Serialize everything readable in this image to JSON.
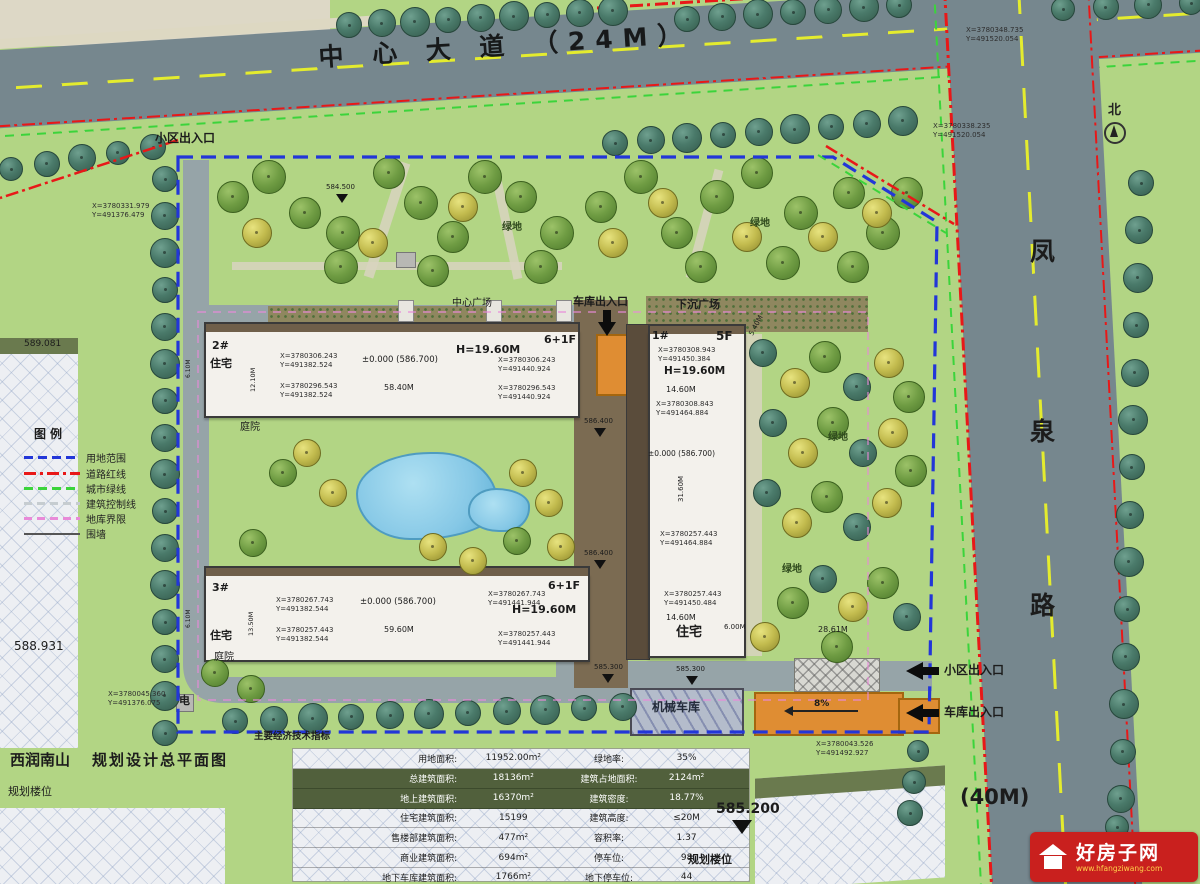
{
  "roads": {
    "main": "中 心 大 道 （24M）",
    "side_chars": [
      "凤",
      "泉",
      "路"
    ],
    "side_width": "(40M)",
    "north": "北"
  },
  "title": {
    "project": "西润南山",
    "drawing": "规划设计总平面图",
    "planned1": "规划楼位",
    "planned2": "规划楼位"
  },
  "legend": {
    "title": "图例",
    "items": [
      {
        "label": "用地范围",
        "color": "#2236d8",
        "style": "dashed"
      },
      {
        "label": "道路红线",
        "color": "#e81818",
        "style": "dash-dot"
      },
      {
        "label": "城市绿线",
        "color": "#3bd43b",
        "style": "dashed"
      },
      {
        "label": "建筑控制线",
        "color": "#c6ccd0",
        "style": "dashed"
      },
      {
        "label": "地库界限",
        "color": "#e88ad8",
        "style": "dashed"
      },
      {
        "label": "围墙",
        "color": "#555555",
        "style": "solid"
      }
    ]
  },
  "labels": {
    "entrance_top": "小区出入口",
    "garage_entrance_top": "车库出入口",
    "plaza_left": "中心广场",
    "plaza_right": "下沉广场",
    "entrance_side": "小区出入口",
    "garage_side": "车库出入口",
    "mech_garage": "机械车库",
    "electric": "电",
    "courtyard1": "庭院",
    "courtyard2": "庭院",
    "green1": "绿地",
    "green2": "绿地",
    "green3": "绿地",
    "green4": "绿地",
    "slope": "8%",
    "dim_2861": "28.61M",
    "dim_600": "6.00M"
  },
  "elevations": {
    "e1": "589.081",
    "e2": "588.931",
    "e3": "585.200",
    "e4": "585.300",
    "e5": "585.300",
    "e6": "584.500",
    "e7": "586.400",
    "e8": "586.400"
  },
  "site_coords": {
    "top_right_outer": [
      "X=3780348.735",
      "Y=491520.054"
    ],
    "top_right_inner": [
      "X=3780338.235",
      "Y=491520.054"
    ],
    "west": [
      "X=3780331.979",
      "Y=491376.479"
    ],
    "south_west": [
      "X=3780045.360",
      "Y=491376.075"
    ],
    "south_east": [
      "X=3780043.526",
      "Y=491492.927"
    ]
  },
  "buildings": {
    "b2": {
      "id": "2#",
      "type": "住宅",
      "floors": "6+1F",
      "height": "H=19.60M",
      "level": "±0.000 (586.700)",
      "length": "58.40M",
      "depth": "12.10M",
      "side": "6.10M",
      "nw": [
        "X=3780306.243",
        "Y=491382.524"
      ],
      "sw": [
        "X=3780296.543",
        "Y=491382.524"
      ],
      "ne": [
        "X=3780306.243",
        "Y=491440.924"
      ],
      "se": [
        "X=3780296.543",
        "Y=491440.924"
      ]
    },
    "b3": {
      "id": "3#",
      "type": "住宅",
      "floors": "6+1F",
      "height": "H=19.60M",
      "level": "±0.000 (586.700)",
      "length": "59.60M",
      "depth": "13.50M",
      "side": "6.10M",
      "nw": [
        "X=3780267.743",
        "Y=491382.544"
      ],
      "sw": [
        "X=3780257.443",
        "Y=491382.544"
      ],
      "ne": [
        "X=3780267.743",
        "Y=491441.944"
      ],
      "se": [
        "X=3780257.443",
        "Y=491441.944"
      ]
    },
    "b1": {
      "id": "1#",
      "type": "住宅",
      "floors": "5F",
      "height": "H=19.60M",
      "level": "±0.000 (586.700)",
      "width_top": "14.60M",
      "width_bottom": "14.60M",
      "depth": "31.60M",
      "gap": "5.40M",
      "c1": [
        "X=3780308.943",
        "Y=491450.384"
      ],
      "c2": [
        "X=3780308.843",
        "Y=491464.884"
      ],
      "c3": [
        "X=3780257.443",
        "Y=491464.884"
      ],
      "c4": [
        "X=3780257.443",
        "Y=491450.484"
      ]
    }
  },
  "table": {
    "header": "主要经济技术指标",
    "rows": [
      {
        "l1": "用地面积:",
        "v1": "11952.00m²",
        "l2": "绿地率:",
        "v2": "35%"
      },
      {
        "l1": "总建筑面积:",
        "v1": "18136m²",
        "l2": "建筑占地面积:",
        "v2": "2124m²"
      },
      {
        "l1": "地上建筑面积:",
        "v1": "16370m²",
        "l2": "建筑密度:",
        "v2": "18.77%"
      },
      {
        "l1": "住宅建筑面积:",
        "v1": "15199",
        "l2": "建筑高度:",
        "v2": "≤20M"
      },
      {
        "l1": "售楼部建筑面积:",
        "v1": "477m²",
        "l2": "容积率:",
        "v2": "1.37"
      },
      {
        "l1": "商业建筑面积:",
        "v1": "694m²",
        "l2": "停车位:",
        "v2": "98"
      },
      {
        "l1": "地下车库建筑面积:",
        "v1": "1766m²",
        "l2": "地下停车位:",
        "v2": "44"
      }
    ]
  },
  "watermark": {
    "name": "好房子网",
    "url": "www.hfangziwang.com"
  },
  "colors": {
    "site_green": "#b2d584",
    "road_gray": "#76878e",
    "boundary_blue": "#2236d8",
    "red_line": "#e81818",
    "green_line": "#3bd43b",
    "pink_line": "#e88ad8",
    "orange": "#df8d33"
  }
}
